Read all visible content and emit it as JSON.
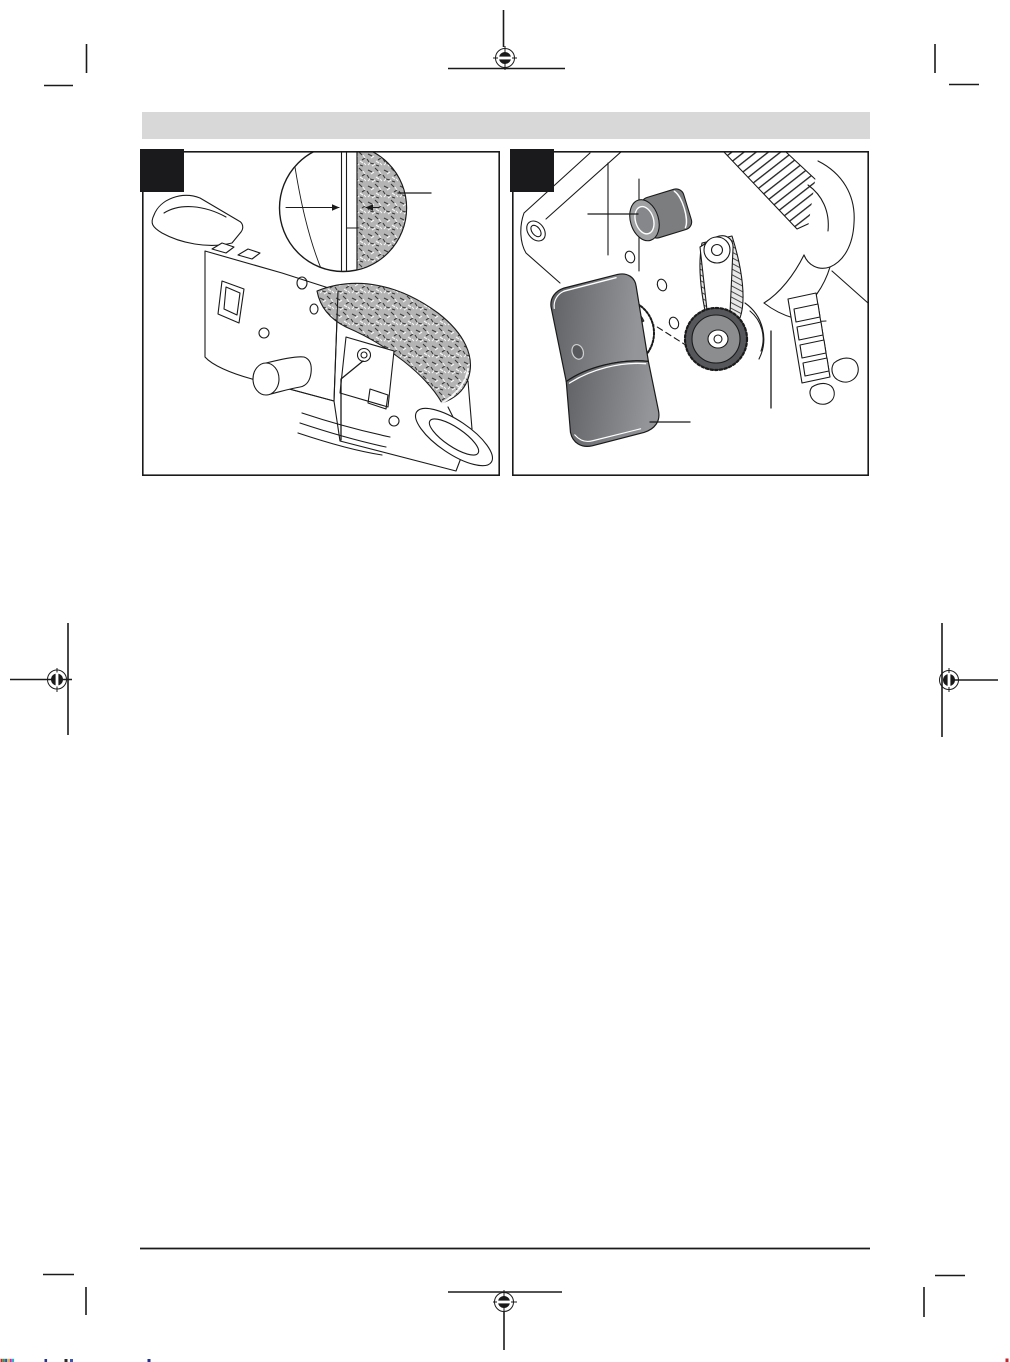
{
  "header_bar": {
    "color": "#d8d8d8",
    "label": ""
  },
  "colors": {
    "page_bg": "#ffffff",
    "ink": "#1a1a1a",
    "figure_border": "#1a1a1a",
    "figure_tag": "#1a1a1c",
    "belt_texture_base": "#b4b4b4",
    "belt_speck_dark": "#3a3a3a",
    "belt_speck_light": "#f6f6f6",
    "roller_body": "#7b7d7f",
    "roller_face": "#9fa1a3",
    "roller_core": "#85878a",
    "cover_dark": "#5e6064",
    "cover_mid": "#7b7d81",
    "cover_light": "#939598",
    "cover_hole": "#57595d",
    "pulley_rim": "#55575a",
    "pulley_face": "#8b8d8f",
    "knob_cutout": "#3f4144"
  },
  "figures": [
    {
      "name": "belt-tracking-alignment-detail",
      "tag_label": ""
    },
    {
      "name": "drive-belt-cover-removed",
      "tag_label": ""
    }
  ],
  "print_marks": {
    "registration_positions": [
      "top-center",
      "left-middle",
      "right-middle",
      "bottom-center"
    ],
    "color_fragments": [
      "#c22525",
      "#2aa344",
      "#2b49c9",
      "#d9c922",
      "#c32bc3",
      "#27b7c9"
    ],
    "stray_fragments": [
      "#27348b",
      "#2b2b2b",
      "#3b55b5",
      "#1f2f8f",
      "#c0262b"
    ]
  }
}
